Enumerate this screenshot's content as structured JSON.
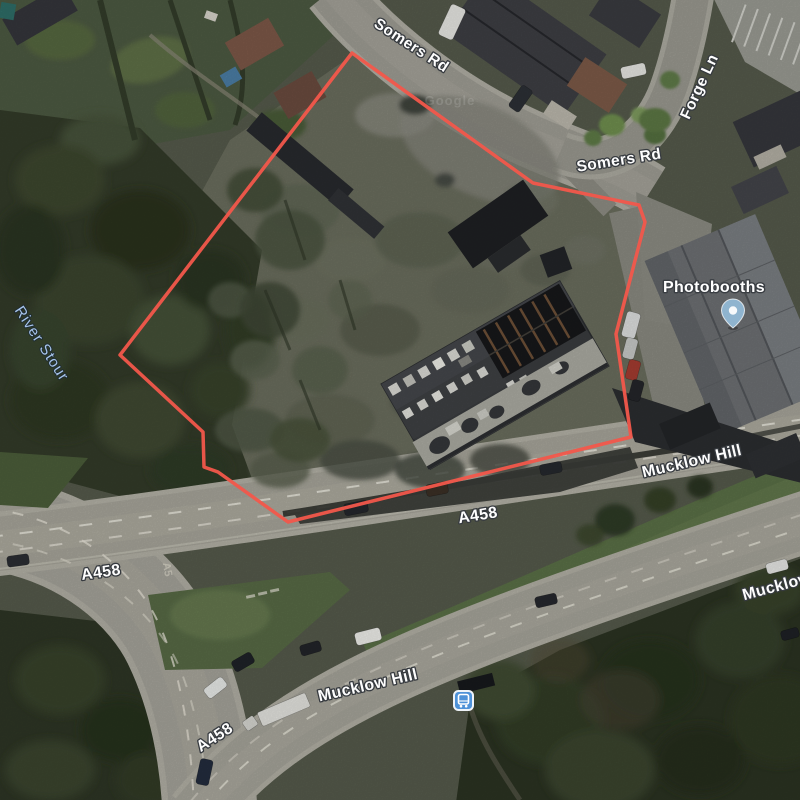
{
  "map": {
    "view_type": "satellite",
    "watermark": "Google",
    "colors": {
      "boundary": "#f2574b",
      "water_label": "#a7c4ea",
      "transit_icon_blue": "#4e92d8",
      "poi_pin_blue": "#8fb4cf"
    },
    "boundary": {
      "color": "#f2574b",
      "points": "352,53 533,183 639,205 645,222 616,334 631,437 288,522 218,472 204,467 203,432 120,355"
    },
    "labels": {
      "somers_rd_a": "Somers Rd",
      "somers_rd_b": "Somers Rd",
      "forge_ln": "Forge Ln",
      "river_stour": "River Stour",
      "photobooths": "Photobooths",
      "mucklow_hill_a": "Mucklow Hill",
      "mucklow_hill_b": "Mucklow Hill",
      "mucklow_hill_c": "Mucklow Hill",
      "a458_a": "A458",
      "a458_b": "A458",
      "a458_c": "A458",
      "road_paint": "A5"
    }
  }
}
